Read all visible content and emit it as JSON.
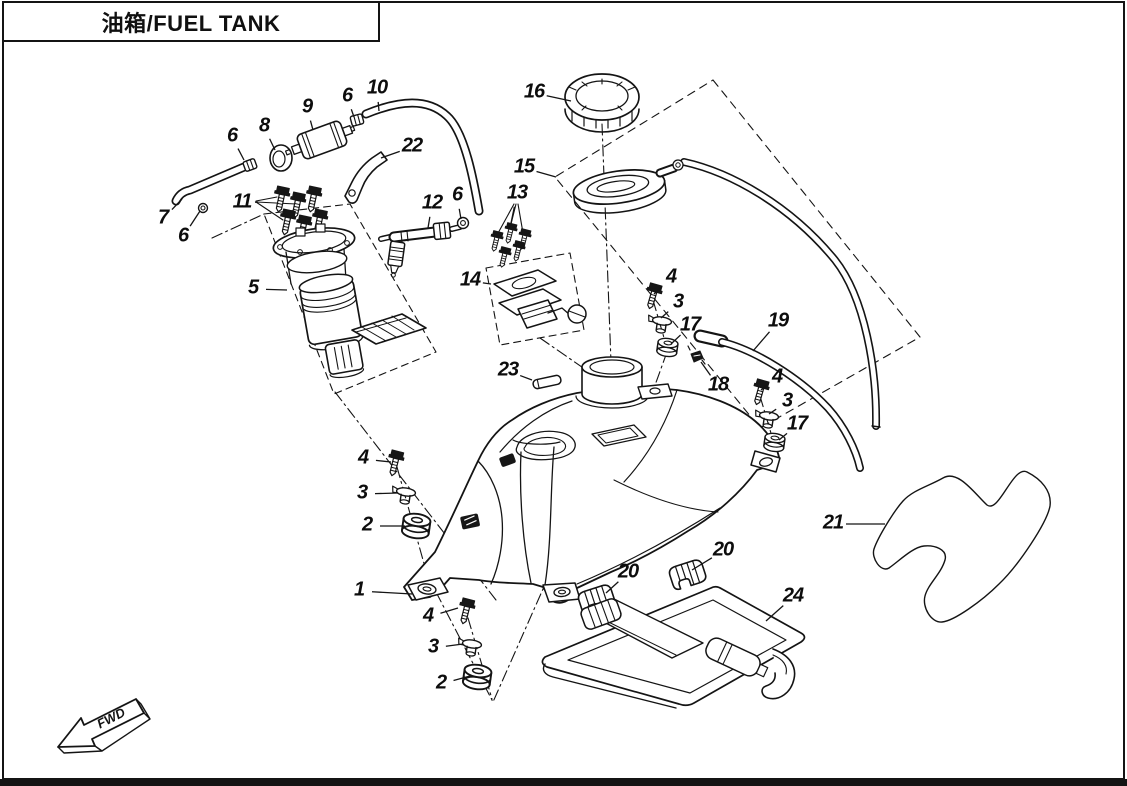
{
  "title": "油箱/FUEL TANK",
  "direction_label": "FWD",
  "colors": {
    "line": "#141414",
    "background": "#ffffff"
  },
  "diagram": {
    "description": "Exploded parts view of fuel tank assembly",
    "callouts": [
      {
        "num": "16",
        "x": 534,
        "y": 93,
        "tx": 571,
        "ty": 101
      },
      {
        "num": "10",
        "x": 377,
        "y": 89,
        "tx": 379,
        "ty": 111
      },
      {
        "num": "6",
        "x": 347,
        "y": 97,
        "tx": 354,
        "ty": 117
      },
      {
        "num": "9",
        "x": 307,
        "y": 108,
        "tx": 313,
        "ty": 130
      },
      {
        "num": "8",
        "x": 264,
        "y": 127,
        "tx": 275,
        "ty": 150
      },
      {
        "num": "6",
        "x": 232,
        "y": 137,
        "tx": 244,
        "ty": 160
      },
      {
        "num": "22",
        "x": 412,
        "y": 147,
        "tx": 381,
        "ty": 158
      },
      {
        "num": "7",
        "x": 163,
        "y": 219,
        "tx": 182,
        "ty": 199
      },
      {
        "num": "6",
        "x": 183,
        "y": 237,
        "tx": 200,
        "ty": 211
      },
      {
        "num": "11",
        "x": 242,
        "y": 203,
        "tx": 258,
        "ty": 202
      },
      {
        "num": "12",
        "x": 432,
        "y": 204,
        "tx": 428,
        "ty": 228
      },
      {
        "num": "6",
        "x": 457,
        "y": 196,
        "tx": 461,
        "ty": 219
      },
      {
        "num": "13",
        "x": 517,
        "y": 194,
        "tx": 510,
        "ty": 228
      },
      {
        "num": "15",
        "x": 524,
        "y": 168,
        "tx": 556,
        "ty": 177
      },
      {
        "num": "5",
        "x": 253,
        "y": 289,
        "tx": 287,
        "ty": 290
      },
      {
        "num": "14",
        "x": 470,
        "y": 281,
        "tx": 491,
        "ty": 284
      },
      {
        "num": "4",
        "x": 671,
        "y": 278,
        "tx": 654,
        "ty": 294
      },
      {
        "num": "3",
        "x": 678,
        "y": 303,
        "tx": 661,
        "ty": 318
      },
      {
        "num": "17",
        "x": 690,
        "y": 326,
        "tx": 671,
        "ty": 344
      },
      {
        "num": "19",
        "x": 778,
        "y": 322,
        "tx": 753,
        "ty": 351
      },
      {
        "num": "18",
        "x": 718,
        "y": 386,
        "tx": 701,
        "ty": 362
      },
      {
        "num": "4",
        "x": 777,
        "y": 378,
        "tx": 761,
        "ty": 390
      },
      {
        "num": "3",
        "x": 787,
        "y": 402,
        "tx": 769,
        "ty": 414
      },
      {
        "num": "17",
        "x": 797,
        "y": 425,
        "tx": 779,
        "ty": 440
      },
      {
        "num": "23",
        "x": 508,
        "y": 371,
        "tx": 532,
        "ty": 380
      },
      {
        "num": "4",
        "x": 363,
        "y": 459,
        "tx": 391,
        "ty": 462
      },
      {
        "num": "3",
        "x": 362,
        "y": 494,
        "tx": 398,
        "ty": 493
      },
      {
        "num": "2",
        "x": 367,
        "y": 526,
        "tx": 405,
        "ty": 526
      },
      {
        "num": "1",
        "x": 359,
        "y": 591,
        "tx": 412,
        "ty": 594
      },
      {
        "num": "4",
        "x": 428,
        "y": 617,
        "tx": 458,
        "ty": 608
      },
      {
        "num": "3",
        "x": 433,
        "y": 648,
        "tx": 463,
        "ty": 644
      },
      {
        "num": "2",
        "x": 441,
        "y": 684,
        "tx": 470,
        "ty": 676
      },
      {
        "num": "20",
        "x": 628,
        "y": 573,
        "tx": 606,
        "ty": 593
      },
      {
        "num": "20",
        "x": 723,
        "y": 551,
        "tx": 692,
        "ty": 570
      },
      {
        "num": "24",
        "x": 793,
        "y": 597,
        "tx": 766,
        "ty": 621
      },
      {
        "num": "21",
        "x": 833,
        "y": 524,
        "tx": 885,
        "ty": 524
      }
    ]
  }
}
